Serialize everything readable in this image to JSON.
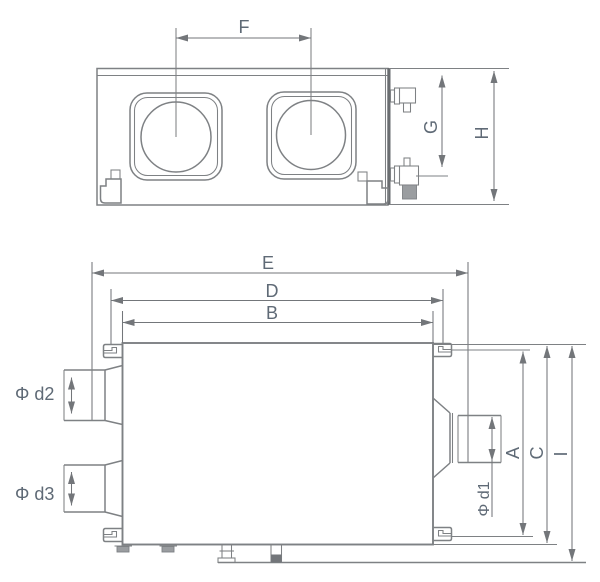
{
  "drawing": {
    "kind": "engineering-dimension-drawing",
    "colors": {
      "line": "#7e8184",
      "dim_line": "#73767a",
      "text": "#5f6a76",
      "dark_edge": "#6a6d70",
      "gray_fill": "#9a9da0",
      "background": "#ffffff"
    }
  },
  "top_view": {
    "labels": {
      "F": "F",
      "G": "G",
      "H": "H"
    }
  },
  "front_view": {
    "labels": {
      "E": "E",
      "D": "D",
      "B": "B",
      "A": "A",
      "C": "C",
      "I": "I",
      "d1": "Φ d1",
      "d2": "Φ d2",
      "d3": "Φ d3"
    }
  }
}
